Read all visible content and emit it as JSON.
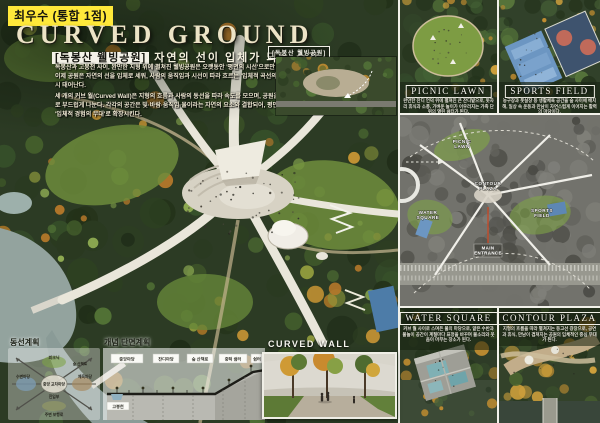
{
  "poster": {
    "award_badge": "최우수 (통합 1점)",
    "title": "CURVED GROUND",
    "subtitle_tag": "[독봉산 웰빙공원]",
    "subtitle_text": "자연의 선이 입체가 되는 순간",
    "paragraph1": "독봉산과 고봉천 사이, 완만한 지형 위에 펼쳐진 웰빙공원은 오랫동안 '평면의 시선'으로만 존재해왔다. 이제 공원은 자연의 선을 입체로 세워, 사람의 움직임과 시선이 따라 흐르는 '입체적 곡선의 공원'으로 다시 태어난다.",
    "paragraph2": "세 개의 커브 월(Curved Wall)은 지형의 흐름과 사람의 동선을 따라 속도를 모으며, 공원을 네 개의 켜로 부드럽게 나눈다. 각각의 공간은 빛·바람·움직임·물이라는 자연의 요소와 결합되어, 평면의 공원을 '입체적 경험의 무대'로 확장시킨다."
  },
  "inset": {
    "label": "[독봉산 웰빙공원]"
  },
  "right_column": {
    "top_cards": [
      {
        "label": "PICNIC LAWN",
        "caption": "완만한 잔디 언덕 위에 펼쳐진 큰 잔디밭으로, 돗자리 휴식과 소풍, 가벼운 놀이가 어우러지는 가족 단위의 열린 쉼터가 된다."
      },
      {
        "label": "SPORTS FIELD",
        "caption": "농구장과 풋살장 등 생활체육 공간을 숲 사이에 배치해, 일상 속 운동과 만남이 자연스럽게 이어지는 활력의 마당이다."
      }
    ],
    "site_plan_labels": {
      "picnic": "PICNIC LAWN",
      "water": "WATER SQUARE",
      "contour": "CONTOUR PLAZA",
      "sports": "SPORTS FIELD",
      "entrance": "MAIN ENTRANCE"
    },
    "bottom_cards": [
      {
        "label": "WATER SQUARE",
        "caption": "커브 월 사이로 스며든 물의 마당으로, 얕은 수반과 물놀이 공간이 계절마다 표정을 바꾸며 물소리와 웃음이 머무는 장소가 된다."
      },
      {
        "label": "CONTOUR PLAZA",
        "caption": "지형의 흐름을 따라 펼쳐지는 등고선 광장으로, 공연과 휴식, 만남이 겹쳐지는 공원의 입체적인 중심 무대가 된다."
      }
    ]
  },
  "diagrams": {
    "circulation": {
      "title": "동선계획",
      "labels": [
        "피크닉",
        "숲 산책로",
        "수변마당",
        "중앙 교차마당",
        "체육마당",
        "진입부",
        "주변 보행로"
      ]
    },
    "section": {
      "title": "개념 단면계획",
      "boxes": [
        "중앙마당",
        "잔디마당",
        "숲 산책로",
        "중턱 쉼터",
        "쉼터"
      ],
      "stream_label": "고봉천"
    },
    "curved_wall": {
      "title": "CURVED WALL"
    }
  },
  "colors": {
    "award_bg": "#ffe93a",
    "title_color": "#ece3c6",
    "forest_dark": "#2c3b24",
    "autumn_orange": "#c08027",
    "wall_white": "#e9e6da",
    "river": "#93a39e",
    "plan_red": "#c24b2a"
  }
}
